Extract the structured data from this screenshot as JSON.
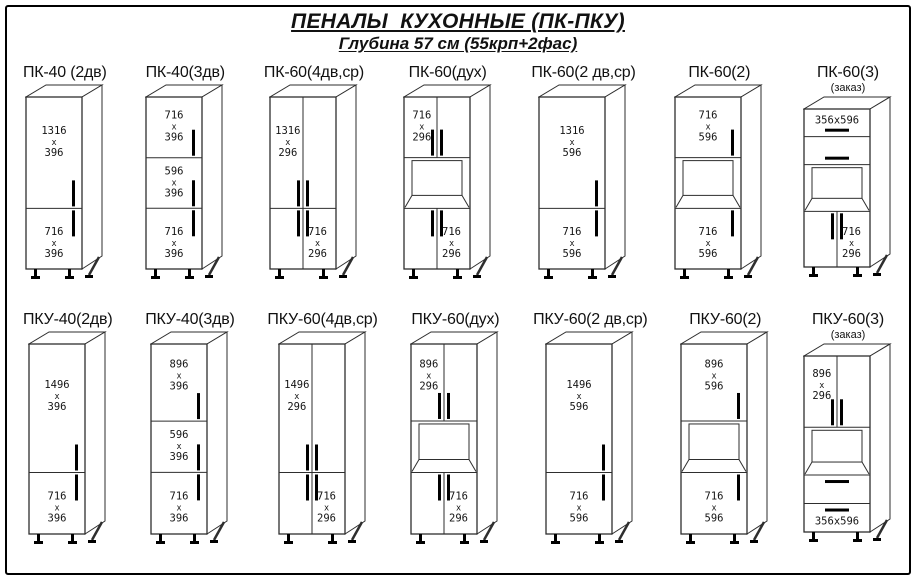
{
  "page": {
    "title": "ПЕНАЛЫ  КУХОННЫЕ (ПК-ПКУ)",
    "subtitle": "Глубина 57 см (55крп+2фас)"
  },
  "colors": {
    "line": "#2e2e2e",
    "handle": "#000000",
    "text": "#141414",
    "face": "#ffffff"
  },
  "rows": [
    {
      "id": "pk",
      "cabinets": [
        {
          "id": "pk-40-2dv",
          "label": "ПК-40 (2дв)",
          "width": 40,
          "sections": [
            {
              "kind": "door",
              "h": 1316,
              "dims": [
                "1316",
                "х",
                "396"
              ],
              "labelPos": "center",
              "handle": "right-bottom"
            },
            {
              "kind": "door",
              "h": 716,
              "dims": [
                "716",
                "х",
                "396"
              ],
              "labelPos": "center",
              "handle": "right-top"
            }
          ]
        },
        {
          "id": "pk-40-3dv",
          "label": "ПК-40(3дв)",
          "width": 40,
          "sections": [
            {
              "kind": "door",
              "h": 716,
              "dims": [
                "716",
                "х",
                "396"
              ],
              "labelPos": "center",
              "handle": "right-bottom"
            },
            {
              "kind": "door",
              "h": 596,
              "dims": [
                "596",
                "х",
                "396"
              ],
              "labelPos": "center",
              "handle": "right-bottom"
            },
            {
              "kind": "door",
              "h": 716,
              "dims": [
                "716",
                "х",
                "396"
              ],
              "labelPos": "center",
              "handle": "right-top"
            }
          ]
        },
        {
          "id": "pk-60-4dv-sr",
          "label": "ПК-60(4дв,ср)",
          "width": 60,
          "sections": [
            {
              "kind": "doors2",
              "h": 1316,
              "dims": [
                "1316",
                "х",
                "296"
              ],
              "labelPos": "left",
              "handle": "center-bottom-pair"
            },
            {
              "kind": "doors2",
              "h": 716,
              "dims": [
                "716",
                "х",
                "296"
              ],
              "labelPos": "right",
              "handle": "center-top-pair"
            }
          ]
        },
        {
          "id": "pk-60-duh",
          "label": "ПК-60(дух)",
          "width": 60,
          "sections": [
            {
              "kind": "doors2",
              "h": 716,
              "dims": [
                "716",
                "х",
                "296"
              ],
              "labelPos": "left",
              "handle": "center-bottom-pair"
            },
            {
              "kind": "niche",
              "h": 600,
              "dims": [],
              "labelPos": "center",
              "handle": "none"
            },
            {
              "kind": "doors2",
              "h": 716,
              "dims": [
                "716",
                "х",
                "296"
              ],
              "labelPos": "right",
              "handle": "center-top-pair"
            }
          ]
        },
        {
          "id": "pk-60-2dv-sr",
          "label": "ПК-60(2 дв,ср)",
          "width": 60,
          "sections": [
            {
              "kind": "door",
              "h": 1316,
              "dims": [
                "1316",
                "х",
                "596"
              ],
              "labelPos": "center",
              "handle": "right-bottom"
            },
            {
              "kind": "door",
              "h": 716,
              "dims": [
                "716",
                "х",
                "596"
              ],
              "labelPos": "center",
              "handle": "right-top"
            }
          ]
        },
        {
          "id": "pk-60-2",
          "label": "ПК-60(2)",
          "width": 60,
          "sections": [
            {
              "kind": "door",
              "h": 716,
              "dims": [
                "716",
                "х",
                "596"
              ],
              "labelPos": "center",
              "handle": "right-bottom"
            },
            {
              "kind": "niche",
              "h": 600,
              "dims": [],
              "labelPos": "center",
              "handle": "none"
            },
            {
              "kind": "door",
              "h": 716,
              "dims": [
                "716",
                "х",
                "596"
              ],
              "labelPos": "center",
              "handle": "right-top"
            }
          ]
        },
        {
          "id": "pk-60-3",
          "label": "ПК-60(3)",
          "sublabel": "(заказ)",
          "width": 60,
          "sections": [
            {
              "kind": "drawer",
              "h": 356,
              "dims": [
                "356х596"
              ],
              "labelPos": "center",
              "handle": "h-bottom"
            },
            {
              "kind": "drawer",
              "h": 360,
              "dims": [],
              "labelPos": "center",
              "handle": "h-bottom"
            },
            {
              "kind": "niche",
              "h": 600,
              "dims": [],
              "labelPos": "center",
              "handle": "none"
            },
            {
              "kind": "doors2",
              "h": 716,
              "dims": [
                "716",
                "х",
                "296"
              ],
              "labelPos": "right",
              "handle": "center-top-pair"
            }
          ]
        }
      ]
    },
    {
      "id": "pku",
      "cabinets": [
        {
          "id": "pku-40-2dv",
          "label": "ПКУ-40(2дв)",
          "width": 40,
          "sections": [
            {
              "kind": "door",
              "h": 1496,
              "dims": [
                "1496",
                "х",
                "396"
              ],
              "labelPos": "center",
              "handle": "right-bottom"
            },
            {
              "kind": "door",
              "h": 716,
              "dims": [
                "716",
                "х",
                "396"
              ],
              "labelPos": "center",
              "handle": "right-top"
            }
          ]
        },
        {
          "id": "pku-40-3dv",
          "label": "ПКУ-40(3дв)",
          "width": 40,
          "sections": [
            {
              "kind": "door",
              "h": 896,
              "dims": [
                "896",
                "х",
                "396"
              ],
              "labelPos": "center",
              "handle": "right-bottom"
            },
            {
              "kind": "door",
              "h": 596,
              "dims": [
                "596",
                "х",
                "396"
              ],
              "labelPos": "center",
              "handle": "right-bottom"
            },
            {
              "kind": "door",
              "h": 716,
              "dims": [
                "716",
                "х",
                "396"
              ],
              "labelPos": "center",
              "handle": "right-top"
            }
          ]
        },
        {
          "id": "pku-60-4dv-sr",
          "label": "ПКУ-60(4дв,ср)",
          "width": 60,
          "sections": [
            {
              "kind": "doors2",
              "h": 1496,
              "dims": [
                "1496",
                "х",
                "296"
              ],
              "labelPos": "left",
              "handle": "center-bottom-pair"
            },
            {
              "kind": "doors2",
              "h": 716,
              "dims": [
                "716",
                "х",
                "296"
              ],
              "labelPos": "right",
              "handle": "center-top-pair"
            }
          ]
        },
        {
          "id": "pku-60-duh",
          "label": "ПКУ-60(дух)",
          "width": 60,
          "sections": [
            {
              "kind": "doors2",
              "h": 896,
              "dims": [
                "896",
                "х",
                "296"
              ],
              "labelPos": "left",
              "handle": "center-bottom-pair"
            },
            {
              "kind": "niche",
              "h": 600,
              "dims": [],
              "labelPos": "center",
              "handle": "none"
            },
            {
              "kind": "doors2",
              "h": 716,
              "dims": [
                "716",
                "х",
                "296"
              ],
              "labelPos": "right",
              "handle": "center-top-pair"
            }
          ]
        },
        {
          "id": "pku-60-2dv-sr",
          "label": "ПКУ-60(2 дв,ср)",
          "width": 60,
          "sections": [
            {
              "kind": "door",
              "h": 1496,
              "dims": [
                "1496",
                "х",
                "596"
              ],
              "labelPos": "center",
              "handle": "right-bottom"
            },
            {
              "kind": "door",
              "h": 716,
              "dims": [
                "716",
                "х",
                "596"
              ],
              "labelPos": "center",
              "handle": "right-top"
            }
          ]
        },
        {
          "id": "pku-60-2",
          "label": "ПКУ-60(2)",
          "width": 60,
          "sections": [
            {
              "kind": "door",
              "h": 896,
              "dims": [
                "896",
                "х",
                "596"
              ],
              "labelPos": "center",
              "handle": "right-bottom"
            },
            {
              "kind": "niche",
              "h": 600,
              "dims": [],
              "labelPos": "center",
              "handle": "none"
            },
            {
              "kind": "door",
              "h": 716,
              "dims": [
                "716",
                "х",
                "596"
              ],
              "labelPos": "center",
              "handle": "right-top"
            }
          ]
        },
        {
          "id": "pku-60-3",
          "label": "ПКУ-60(3)",
          "sublabel": "(заказ)",
          "width": 60,
          "sections": [
            {
              "kind": "doors2",
              "h": 896,
              "dims": [
                "896",
                "х",
                "296"
              ],
              "labelPos": "left",
              "handle": "center-bottom-pair"
            },
            {
              "kind": "niche",
              "h": 600,
              "dims": [],
              "labelPos": "center",
              "handle": "none"
            },
            {
              "kind": "drawer",
              "h": 358,
              "dims": [],
              "labelPos": "center",
              "handle": "h-top"
            },
            {
              "kind": "drawer",
              "h": 358,
              "dims": [
                "356х596"
              ],
              "labelPos": "center",
              "handle": "h-top"
            }
          ]
        }
      ]
    }
  ]
}
